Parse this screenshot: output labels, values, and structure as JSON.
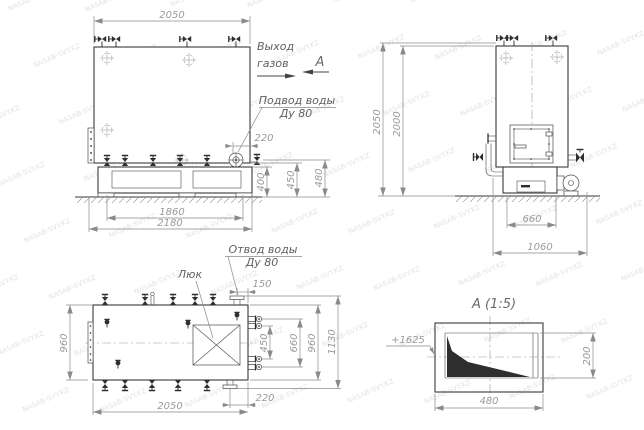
{
  "watermark": {
    "text": "NASAB-SVY.KZ"
  },
  "annotations": {
    "gas_exit_line1": "Выход",
    "gas_exit_line2": "газов",
    "view_label": "А",
    "water_inlet_line1": "Подвод воды",
    "water_inlet_line2": "Ду 80",
    "water_outlet_line1": "Отвод воды",
    "water_outlet_line2": "Ду 80",
    "hatch_label": "Люк",
    "detail_title": "А (1:5)",
    "elevation_mark": "+1625"
  },
  "front_view": {
    "dims": {
      "top_width": "2050",
      "frame_inner": "1860",
      "frame_outer": "2180",
      "inlet_offset": "220",
      "h_frame": "400",
      "h_body": "450",
      "h_inlet": "480"
    }
  },
  "side_view": {
    "dims": {
      "total_height": "2050",
      "body_height": "2000",
      "furnace_width": "660",
      "overall_depth": "1060"
    }
  },
  "plan_view": {
    "dims": {
      "length": "2050",
      "width_left": "960",
      "nozzle_span_inner": "450",
      "nozzle_span_outer": "660",
      "width_right": "960",
      "flange_span": "1130",
      "outlet_offset": "150",
      "drain_offset": "220"
    }
  },
  "detail_a": {
    "dims": {
      "width": "480",
      "height": "200"
    }
  }
}
